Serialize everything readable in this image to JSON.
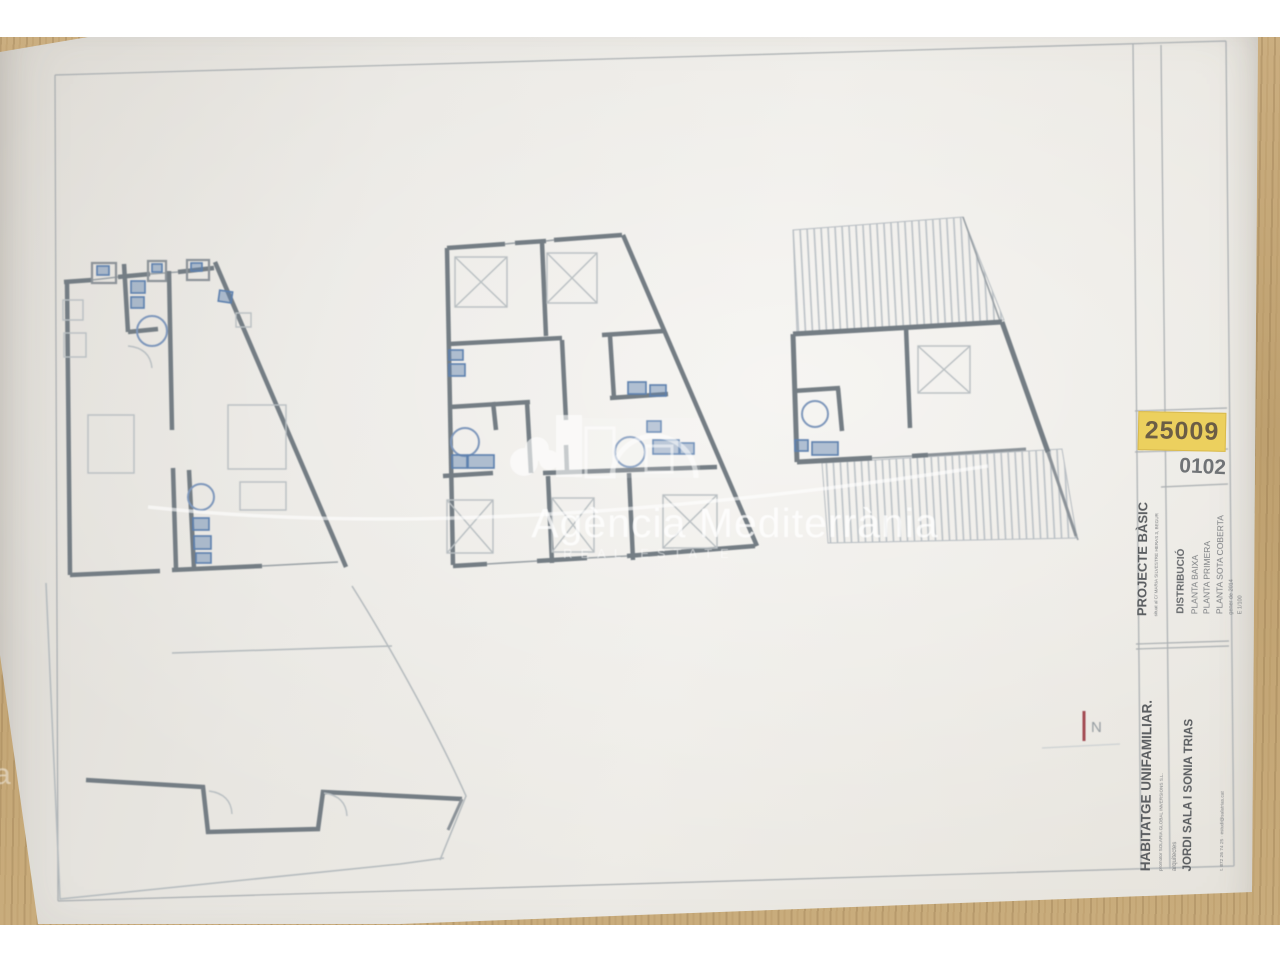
{
  "sheet": {
    "badge_ref": "25009",
    "code_ref": "0102",
    "title_block": {
      "project": {
        "label": "PROJECTE BÀSIC",
        "subtitle": "situat al C/ MARIA SILVESTRE HERAS 3, BEGUR"
      },
      "drawing": {
        "title": "DISTRIBUCIÓ",
        "lines": [
          "PLANTA BAIXA",
          "PLANTA PRIMERA",
          "PLANTA SOTA COBERTA"
        ],
        "date": "gener de 2014",
        "scale": "E 1/100"
      },
      "client": {
        "label": "HABITATGE UNIFAMILIAR.",
        "subtitle": "promotor   SOLARIA GLOBAL INVERSIONS S.L."
      },
      "architects": {
        "label": "arquitectes",
        "names": "JORDI SALA I SONIA TRIAS",
        "contact": "t. 872 26 74 25 · estudi@salatrias.cat"
      }
    },
    "north_label": "N"
  },
  "watermark": {
    "brand": "Agència Mediterrània",
    "tagline": "REAL ESTATE"
  },
  "colors": {
    "badge_bg": "#ecd05e",
    "badge_text": "#6b5d45",
    "wall_gray": "#747d84",
    "fixture_blue": "#5d80ae",
    "furniture_gray": "#b9bfc2",
    "paper": "#e9e6e1",
    "wood": "#c4a678",
    "frame_line": "#a8adb0",
    "north_red": "#a34a52",
    "watermark_white": "#ffffff"
  }
}
